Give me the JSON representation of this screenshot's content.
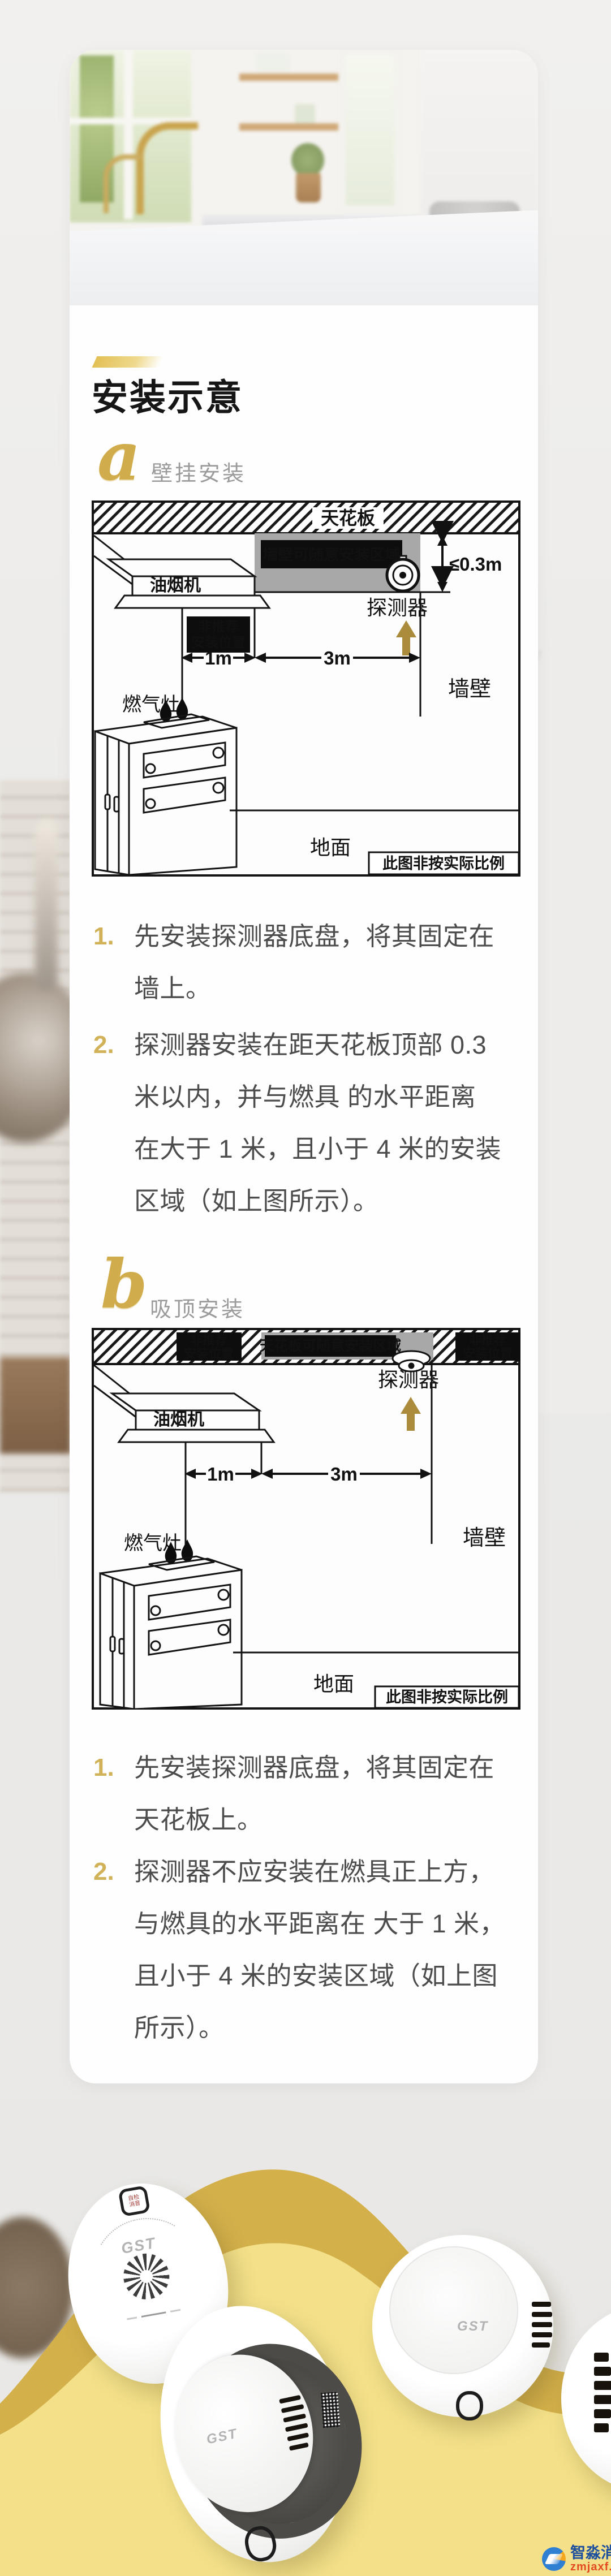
{
  "colors": {
    "accent_gold": "#d2b258",
    "diagram_gray": "#a8a8a8",
    "yellow_light": "#f3e089",
    "yellow_dark": "#d3b04a",
    "step_text": "#4c4c4c",
    "section_label": "#9b9b9b"
  },
  "header": {
    "title": "安装示意"
  },
  "sections": [
    {
      "letter": "a",
      "label": "壁挂安装",
      "diagram": {
        "ceiling": "天花板",
        "zone": "墙壁可随意安装区域",
        "clearance": "≤0.3m",
        "detector": "探测器",
        "hood": "油烟机",
        "not_recommended_line1": "非推荐",
        "not_recommended_line2": "安装位置",
        "dim_1m": "1m",
        "dim_3m": "3m",
        "wall": "墙壁",
        "stove": "燃气灶",
        "floor": "地面",
        "scale_note": "此图非按实际比例"
      },
      "steps": [
        {
          "num": "1.",
          "lines": [
            "先安装探测器底盘，将其固定在",
            "墙上。"
          ]
        },
        {
          "num": "2.",
          "lines": [
            "探测器安装在距天花板顶部 0.3",
            "米以内，并与燃具 的水平距离",
            "在大于 1 米，且小于 4 米的安装",
            "区域（如上图所示）。"
          ]
        }
      ]
    },
    {
      "letter": "b",
      "label": "吸顶安装",
      "diagram": {
        "zone": "天花板可随意安装区域",
        "detector": "探测器",
        "hood": "油烟机",
        "not_recommended_line1": "非推荐",
        "not_recommended_line2": "安装位置",
        "dim_1m": "1m",
        "dim_3m": "3m",
        "wall": "墙壁",
        "stove": "燃气灶",
        "floor": "地面",
        "scale_note": "此图非按实际比例"
      },
      "steps": [
        {
          "num": "1.",
          "lines": [
            "先安装探测器底盘，将其固定在",
            "天花板上。"
          ]
        },
        {
          "num": "2.",
          "lines": [
            "探测器不应安装在燃具正上方，",
            "与燃具的水平距离在 大于 1 米，",
            "且小于 4 米的安装区域（如上图",
            "所示）。"
          ]
        }
      ]
    }
  ],
  "products": {
    "brand": "GST",
    "button_line1": "自检",
    "button_line2": "消音"
  },
  "watermark": {
    "name": "智淼消防",
    "site": "zmjaxf.com"
  }
}
